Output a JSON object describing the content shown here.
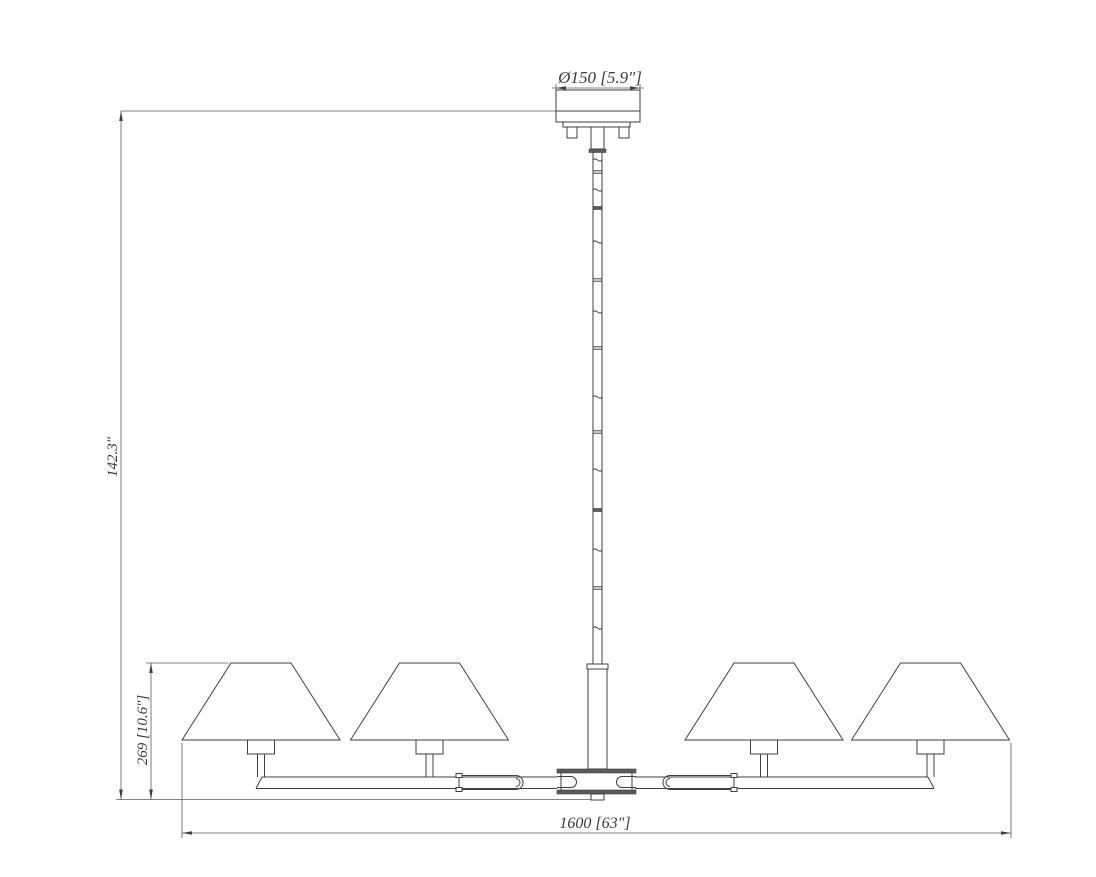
{
  "drawing": {
    "type": "technical-dimension-drawing",
    "subject": "four-light linear chandelier elevation",
    "background_color": "#ffffff",
    "line_color": "#3f3f3f",
    "dimensions": {
      "canopy_diameter": "Ø150 [5.9\"]",
      "overall_height": "142.3\"",
      "body_height": "269 [10.6\"]",
      "overall_width": "1600 [63\"]"
    }
  }
}
